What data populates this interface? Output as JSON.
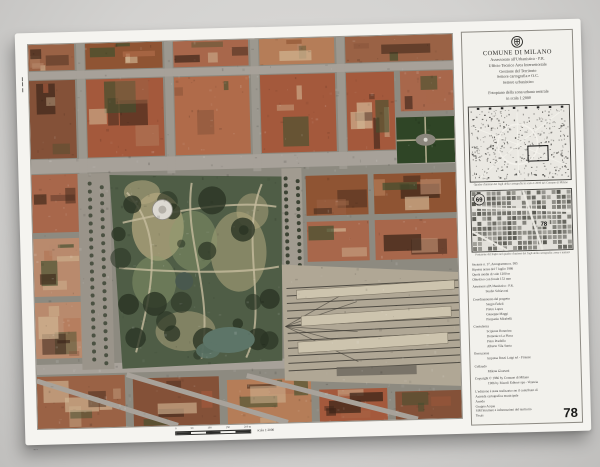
{
  "palette": {
    "page_bg": "#d3d2d0",
    "poster_bg": "#f5f4f0",
    "panel_bg": "#f2f1ec",
    "street": "#8d8a80",
    "street_light": "#a7a199",
    "terracotta": [
      "#a4593c",
      "#b06b4a",
      "#8f5433",
      "#b57d58",
      "#9a6245",
      "#845138",
      "#b98a6d",
      "#a8674b"
    ],
    "park_base": "#4f5d46",
    "park_dark": "#2a3424",
    "park_light": "#8f9b6e",
    "park_tan": "#b3a77f",
    "path": "#c6bc9e",
    "pond": "#5d7568",
    "pond_dark": "#49584e",
    "rail_base": "#b0a795",
    "platform": "#cdc4ae",
    "track": "#3f3c35",
    "piazza_green": "#2f4526",
    "ink": "#2a2a27"
  },
  "panel": {
    "org_title": "COMUNE DI MILANO",
    "org_lines": [
      "Assessorato all'Urbanistica - P.R.",
      "Ufficio Tecnico Area Intersettoriale",
      "Gestione del Territorio",
      "Settore cartografia e O.C.",
      "Settore urbanistico"
    ],
    "subtitle_line1": "Fotopiano della zona urbana centrale",
    "subtitle_line2": "in scala 1:2000",
    "map1_caption": "Quadro d'unione dei fogli della cartografia in scala 1:2000 del Comune di Milano",
    "map2_caption": "Posizione del foglio nel quadro d'unione dei fogli della cartografia: zona e numeri",
    "map2_label_a": "69",
    "map2_label_b": "78",
    "tech_lines": [
      "Sezione n. 17, Aerogramma n. 995",
      "Ripresa aerea del 7 luglio 1986",
      "Quota media di volo 1200 m",
      "Obiettivo con focale 153 mm"
    ],
    "credits": [
      {
        "label": "Assessore all'Urbanistica - P.R.",
        "names": [
          "Studio Schiavoni"
        ]
      },
      {
        "label": "Coordinamento del progetto",
        "names": [
          "Sergio Fedeli",
          "Pietro Lopez",
          "Giuseppe Maggi",
          "Pierpaolo Mirabelli"
        ]
      },
      {
        "label": "Consulenza",
        "names": [
          "Scipione Bonacina",
          "Domenico La Placa",
          "Piero Pradella",
          "Alberto Vila Santa"
        ]
      },
      {
        "label": "Esecuzione",
        "names": [
          "Impresa Rossi Luigi srl - Firenze"
        ]
      },
      {
        "label": "Collaudo",
        "names": [
          "Milena Giussani"
        ]
      }
    ],
    "copyright_lines": [
      "Copyright © 1986 by Comune di Milano",
      "1986 by Rizzoli Editore spa - Venezia",
      "L'edizione è stata realizzata con il contributo di"
    ],
    "contrib_lines": [
      "Azienda cartografica municipale",
      "Arredo",
      "Gruppo Acqua",
      "SIM Strutture e informazioni del territorio",
      "Texas"
    ],
    "sheet_number": "78"
  },
  "footer": {
    "scale_ticks": [
      "0",
      "50",
      "100",
      "150",
      "200 m"
    ],
    "scale_text": "scala 1:2000"
  }
}
